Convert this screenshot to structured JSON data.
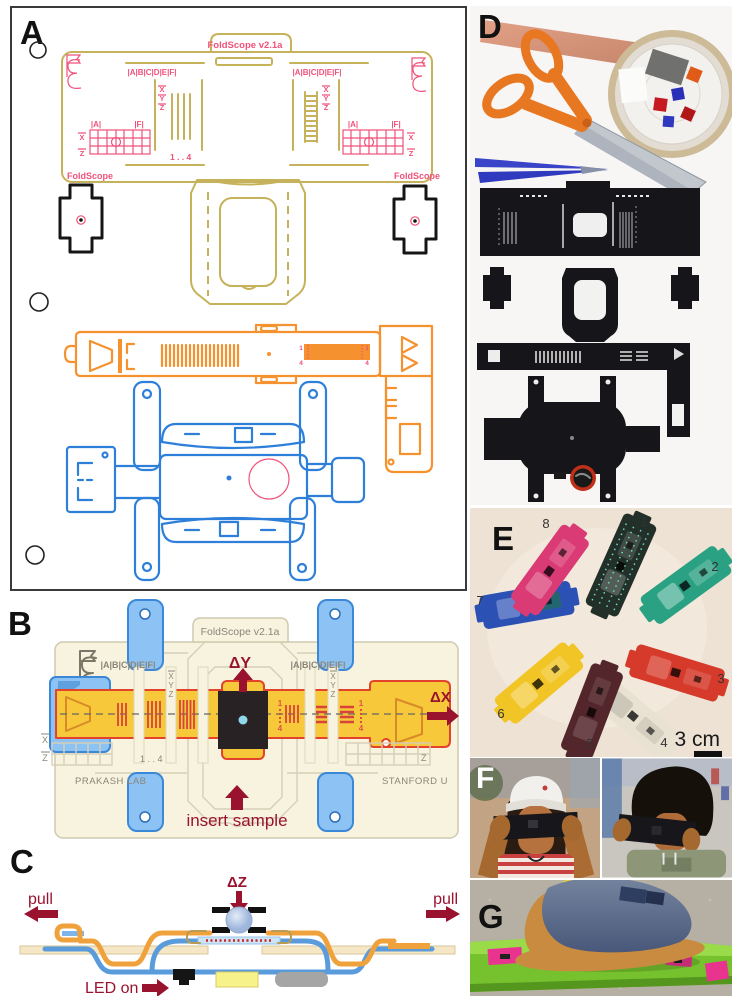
{
  "figure": {
    "description": "Foldscope origami paper microscope - multi-panel figure",
    "palette": {
      "olive": "#C6B25A",
      "pink": "#F0527A",
      "orange": "#F5922F",
      "blue": "#2E7FD9",
      "cream": "#F8F3DF",
      "yellow_slider": "#F7C839",
      "red_outline": "#E4432B",
      "tab_blue": "#8CC3F4",
      "dark_red": "#99132F",
      "gray_label": "#8A8578",
      "sample_black": "#292225",
      "cyan_dot": "#8FD8EC"
    }
  },
  "panel_a": {
    "label": "A",
    "title": "FoldScope v2.1a",
    "row_label": "|A|B|C|D|E|F|",
    "axis_x": "X",
    "axis_y": "Y",
    "axis_z": "Z",
    "grid_a": "|A|",
    "grid_f": "|F|",
    "range_label": "1 . . 4",
    "tick_1": "1",
    "tick_4": "4",
    "brand": "FoldScope"
  },
  "panel_b": {
    "label": "B",
    "title": "FoldScope v2.1a",
    "row_label": "|A|B|C|D|E|F|",
    "axis_x": "X",
    "axis_y": "Y",
    "axis_z": "Z",
    "delta_y": "ΔY",
    "delta_x": "ΔX",
    "tick_1": "1",
    "tick_4": "4",
    "range_label": "1 . . 4",
    "insert_sample": "insert sample",
    "lab": "PRAKASH LAB",
    "university": "STANFORD U"
  },
  "panel_c": {
    "label": "C",
    "delta_z": "ΔZ",
    "pull_left": "pull",
    "pull_right": "pull",
    "led_on": "LED on"
  },
  "panel_d": {
    "label": "D"
  },
  "panel_e": {
    "label": "E",
    "scale_label": "3 cm",
    "scopes": [
      {
        "number": "1",
        "color": "#233029"
      },
      {
        "number": "2",
        "color": "#2BA183"
      },
      {
        "number": "3",
        "color": "#D63A2A"
      },
      {
        "number": "4",
        "color": "#E9E2D2"
      },
      {
        "number": "5",
        "color": "#53262B"
      },
      {
        "number": "6",
        "color": "#F2C526"
      },
      {
        "number": "7",
        "color": "#2B51B4"
      },
      {
        "number": "8",
        "color": "#DA3B74"
      }
    ]
  },
  "panel_f": {
    "label": "F"
  },
  "panel_g": {
    "label": "G"
  }
}
